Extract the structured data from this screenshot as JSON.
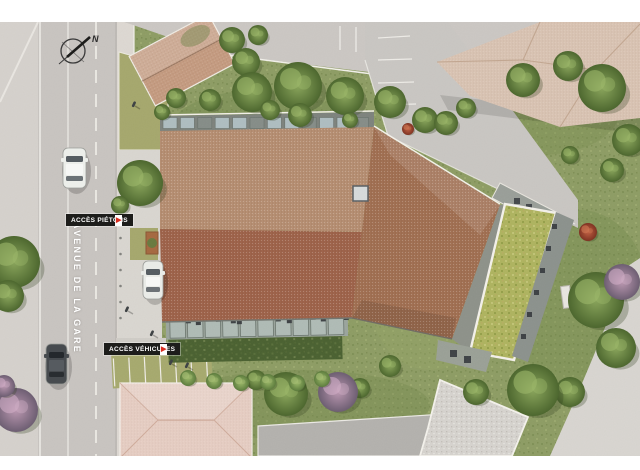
{
  "plan": {
    "title": "aerial residence site plan",
    "compass": {
      "label": "N"
    },
    "street": {
      "name": "AVENUE DE LA GARE"
    },
    "access_labels": [
      {
        "id": "pedestrian",
        "text": "ACCÈS PIÉTONS"
      },
      {
        "id": "vehicle",
        "text": "ACCÈS VÉHICULES"
      }
    ],
    "icons": {
      "access_arrow": "▶",
      "north_arrow": "compass-needle"
    },
    "colors": {
      "label_bg": "#1d1d1b",
      "label_text": "#ffffff",
      "arrow_red": "#d92d20",
      "roof_light": "#b58d70",
      "roof_dark": "#9d6148",
      "roof_wing": "#a06e50",
      "green_roof": "#aeb35e",
      "grass": "#8d9c63",
      "road": "#c8c4c0",
      "olive_paving": "#a5a76c",
      "neighbor_roof_pale": "#d9c3b2",
      "neighbor_roof_pink": "#e6cdc2"
    }
  }
}
